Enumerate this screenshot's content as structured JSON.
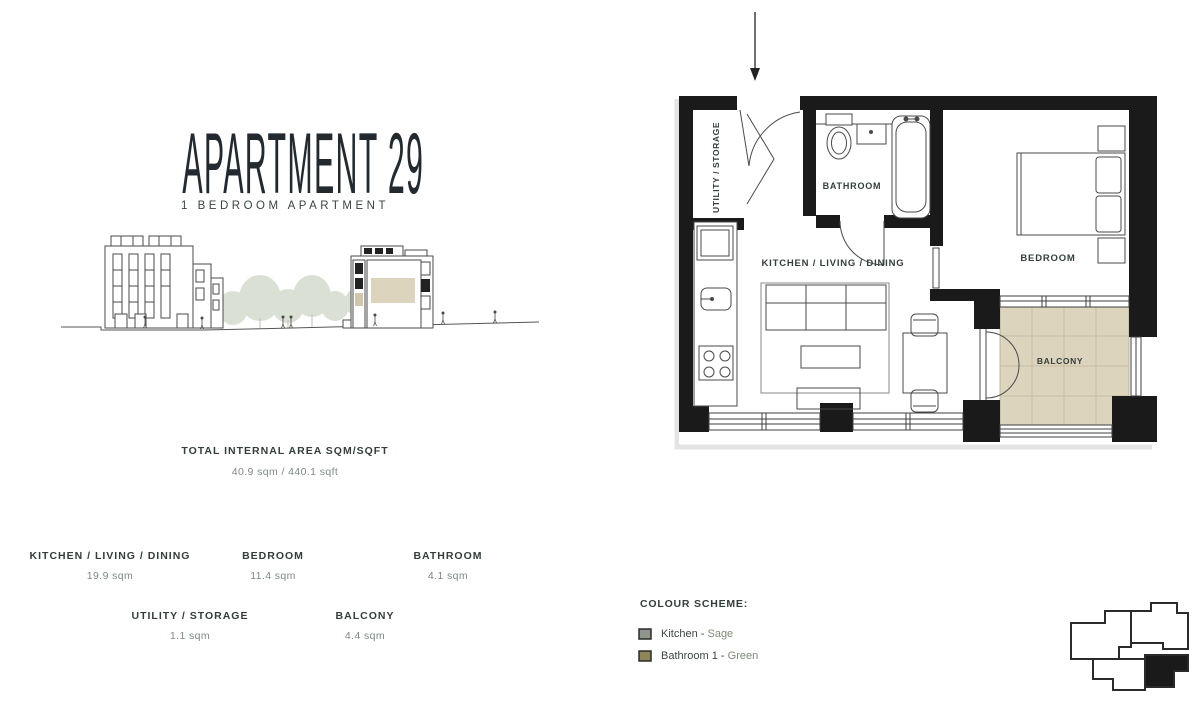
{
  "header": {
    "title": "APARTMENT 29",
    "subtitle": "1 BEDROOM APARTMENT"
  },
  "total_area": {
    "label": "TOTAL INTERNAL AREA SQM/SQFT",
    "value": "40.9 sqm / 440.1 sqft"
  },
  "rooms": [
    {
      "name": "KITCHEN / LIVING / DINING",
      "area": "19.9 sqm"
    },
    {
      "name": "BEDROOM",
      "area": "11.4 sqm"
    },
    {
      "name": "BATHROOM",
      "area": "4.1 sqm"
    },
    {
      "name": "UTILITY / STORAGE",
      "area": "1.1 sqm"
    },
    {
      "name": "BALCONY",
      "area": "4.4 sqm"
    }
  ],
  "colour_scheme": {
    "heading": "COLOUR SCHEME:",
    "items": [
      {
        "room": "Kitchen -",
        "colour": "Sage",
        "swatch": "#8F958A"
      },
      {
        "room": "Bathroom 1 -",
        "colour": "Green",
        "swatch": "#8D8458"
      }
    ]
  },
  "floor_plan": {
    "labels": {
      "utility": "UTILITY / STORAGE",
      "bathroom": "BATHROOM",
      "kitchen_living_dining": "KITCHEN / LIVING / DINING",
      "bedroom": "BEDROOM",
      "balcony": "BALCONY"
    },
    "balcony_floor_color": "#DDD4BE"
  }
}
